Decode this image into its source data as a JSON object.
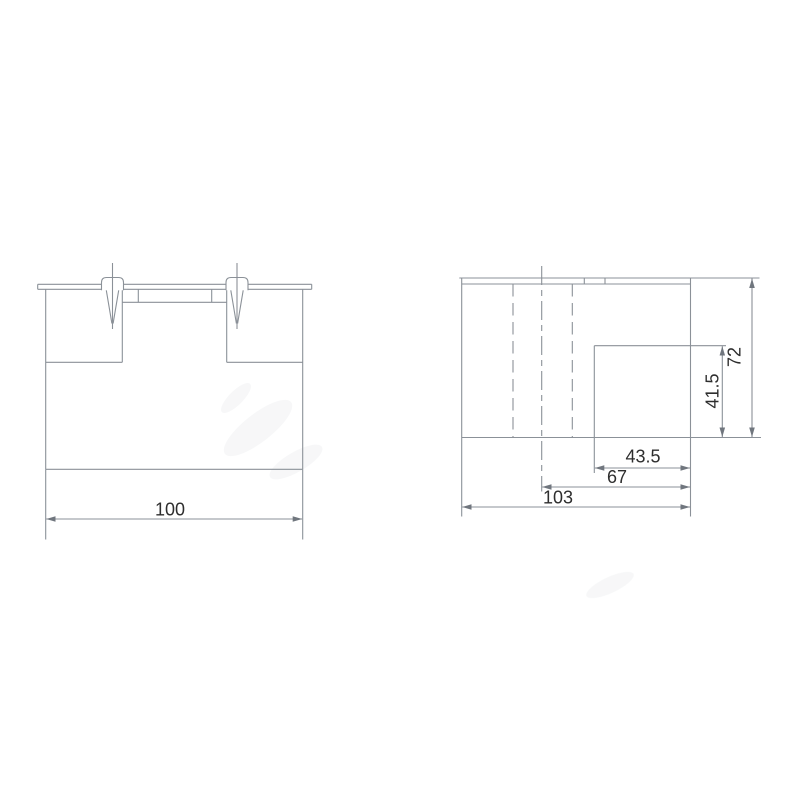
{
  "drawing": {
    "type": "technical-drawing",
    "background": "#ffffff",
    "colors": {
      "line": "#8b9198",
      "text": "#2e2e2e",
      "arrow": "#70767e"
    },
    "views": {
      "front": {
        "name": "front-view",
        "dimensions": {
          "width": {
            "label": "100"
          }
        }
      },
      "side": {
        "name": "side-view",
        "dimensions": {
          "recess_width": {
            "label": "43.5"
          },
          "recess_offset": {
            "label": "67"
          },
          "overall_depth": {
            "label": "103"
          },
          "recess_height": {
            "label": "41.5"
          },
          "overall_height": {
            "label": "72"
          }
        }
      }
    }
  }
}
